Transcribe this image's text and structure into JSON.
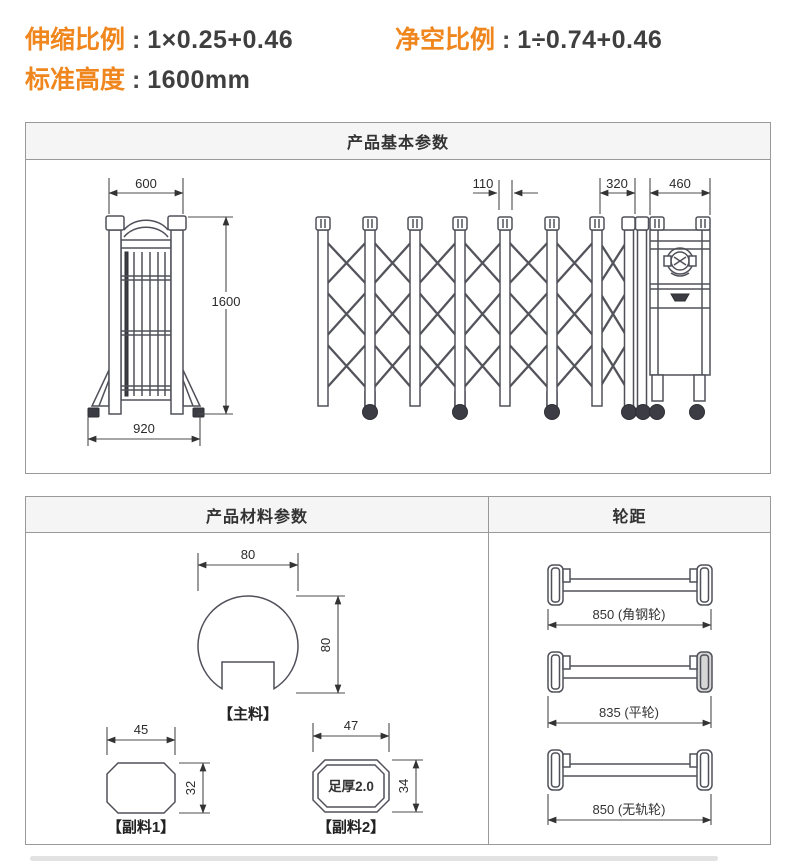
{
  "top_info": {
    "colon": " : ",
    "items": [
      {
        "label": "伸缩比例",
        "value": "1×0.25+0.46"
      },
      {
        "label": "净空比例",
        "value": "1÷0.74+0.46"
      },
      {
        "label": "标准高度",
        "value": "1600mm"
      }
    ],
    "accent_color": "#f0861e"
  },
  "basic_panel": {
    "title": "产品基本参数",
    "front_view": {
      "top_width": "600",
      "height": "1600",
      "bottom_width": "920"
    },
    "expanded_view": {
      "post_pitch": "110",
      "folded_length": "320",
      "motor_head_width": "460"
    }
  },
  "material_panel": {
    "title": "产品材料参数",
    "main_profile": {
      "width": "80",
      "height": "80",
      "caption": "【主料】"
    },
    "sub_profile_1": {
      "width": "45",
      "height": "32",
      "caption": "【副料1】"
    },
    "sub_profile_2": {
      "width": "47",
      "height": "34",
      "thickness_note": "足厚2.0",
      "caption": "【副料2】"
    }
  },
  "wheel_panel": {
    "title": "轮距",
    "items": [
      {
        "label": "850 (角钢轮)"
      },
      {
        "label": "835 (平轮)"
      },
      {
        "label": "850 (无轨轮)"
      }
    ]
  }
}
